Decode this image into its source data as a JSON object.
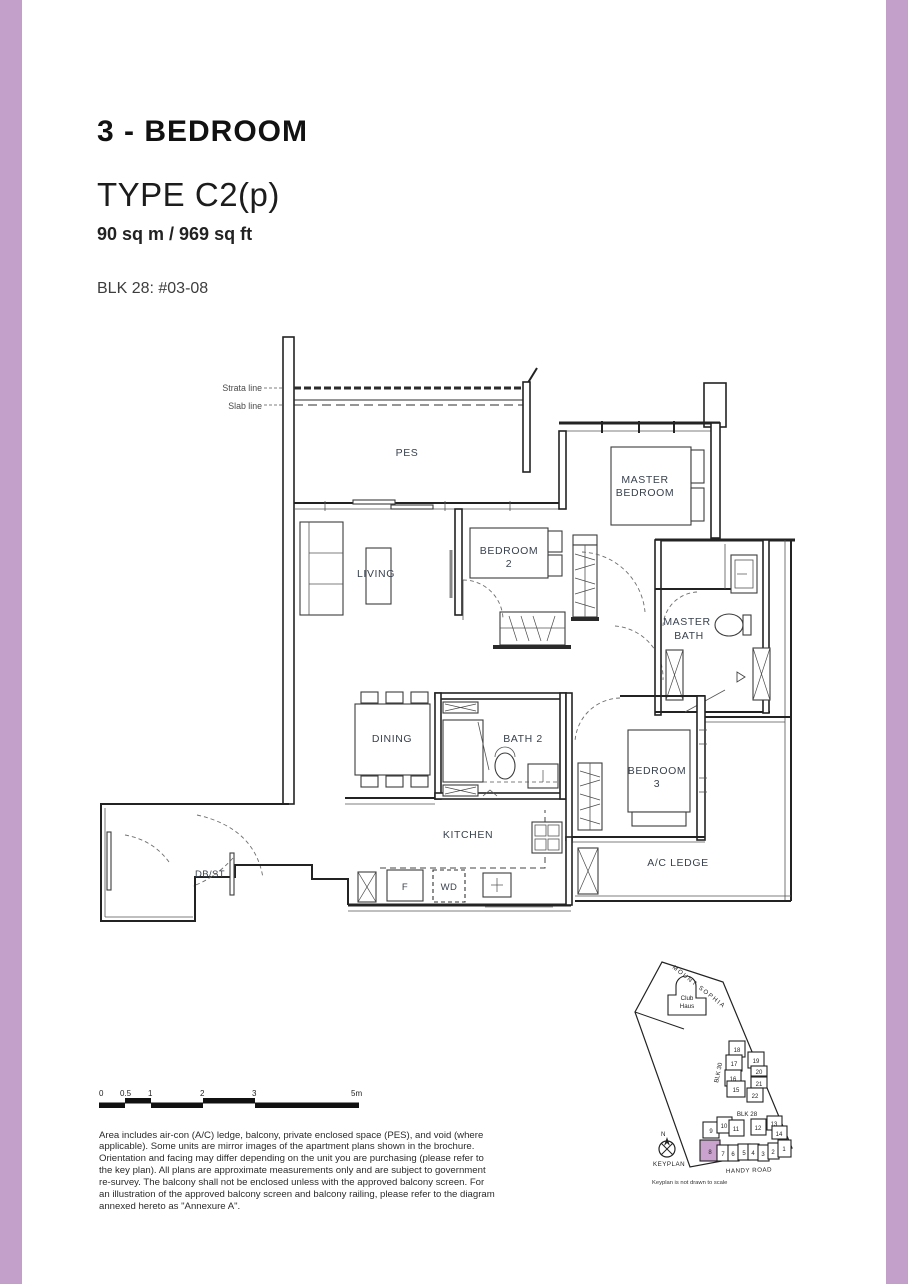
{
  "page": {
    "border_color": "#c2a0c9",
    "background": "#ffffff"
  },
  "header": {
    "title": "3 - BEDROOM",
    "type": "TYPE C2(p)",
    "area": "90 sq m / 969 sq ft",
    "block_unit": "BLK 28: #03-08"
  },
  "floorplan": {
    "annotations": {
      "strata_line": "Strata line",
      "slab_line": "Slab line"
    },
    "rooms": {
      "pes": "PES",
      "master_bedroom": [
        "MASTER",
        "BEDROOM"
      ],
      "living": "LIVING",
      "bedroom2": [
        "BEDROOM",
        "2"
      ],
      "master_bath": [
        "MASTER",
        "BATH"
      ],
      "dining": "DINING",
      "bath2": "BATH 2",
      "bedroom3": [
        "BEDROOM",
        "3"
      ],
      "kitchen": "KITCHEN",
      "ac_ledge": "A/C LEDGE",
      "db_st": "DB/ST",
      "fridge": "F",
      "washer_dryer": "WD"
    }
  },
  "scalebar": {
    "labels": [
      "0",
      "0.5",
      "1",
      "2",
      "3",
      "5m"
    ]
  },
  "disclaimer": {
    "text": "Area includes air-con (A/C) ledge, balcony, private enclosed space (PES), and void (where applicable). Some units are mirror images of the apartment plans shown in the brochure. Orientation and facing may differ depending on the unit you are purchasing (please refer to the key plan). All plans are approximate measurements only and are subject to government re-survey. The balcony shall not be enclosed unless with the approved balcony screen. For an illustration of the approved balcony screen and balcony railing, please refer to the diagram annexed hereto as \"Annexure A\"."
  },
  "keyplan": {
    "road_top": "MOUNT SOPHIA",
    "club_haus": [
      "Club",
      "Haus"
    ],
    "blk30_label": "BLK 30",
    "blk28_label": "BLK 28",
    "north": "N",
    "keyplan_label": "KEYPLAN",
    "road_bottom": "HANDY ROAD",
    "note": "Keyplan is not drawn to scale",
    "highlight_color": "#c9a3ce",
    "blk30_units": [
      "18",
      "17",
      "19",
      "16",
      "20",
      "21",
      "15",
      "22"
    ],
    "blk28_units_row1": [
      "9",
      "10",
      "11",
      "12",
      "13",
      "14"
    ],
    "blk28_units_row2": [
      "8",
      "7",
      "6",
      "5",
      "4",
      "3",
      "2",
      "1"
    ]
  }
}
